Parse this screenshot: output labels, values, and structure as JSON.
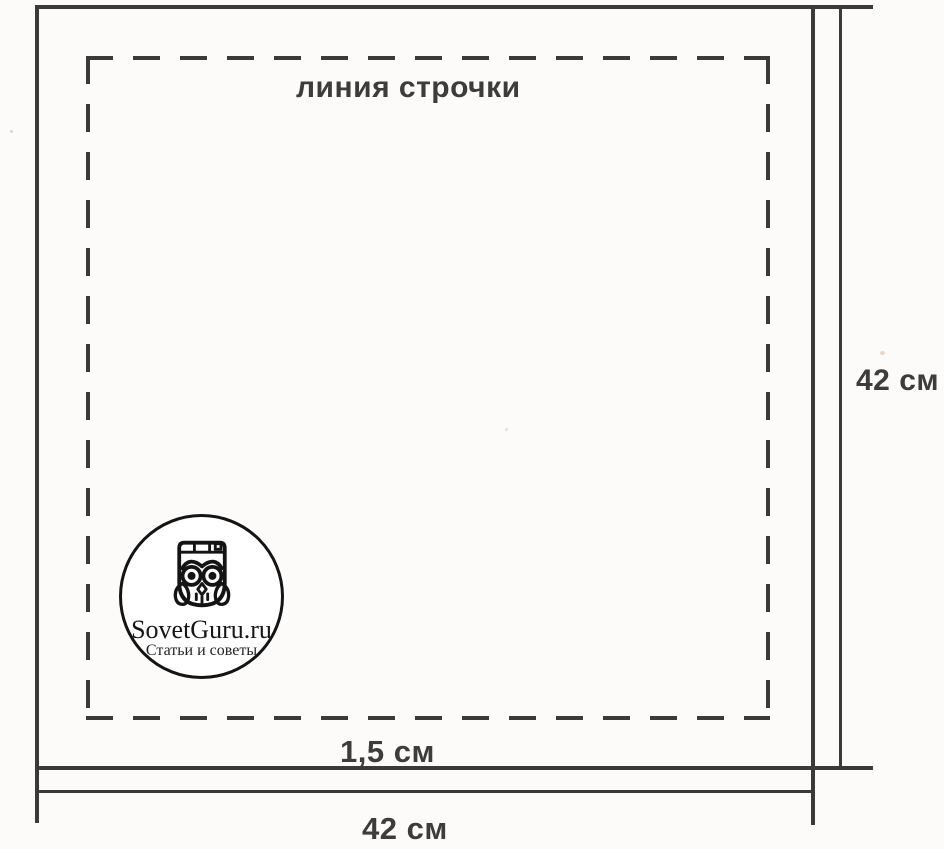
{
  "page": {
    "background": "#fcfbf9",
    "ink_color": "#3a3a3a"
  },
  "diagram": {
    "type": "sewing-pattern-square",
    "fabric_square": {
      "width_cm": 42,
      "height_cm": 42
    },
    "seam_allowance_cm": 1.5
  },
  "labels": {
    "stitch_line": "линия строчки",
    "seam_allowance": "1,5 см",
    "bottom_width": "42 см",
    "right_height": "42 см"
  },
  "logo": {
    "icon": "owl-icon",
    "site_name": "SovetGuru.ru",
    "tagline": "Статьи и советы"
  }
}
